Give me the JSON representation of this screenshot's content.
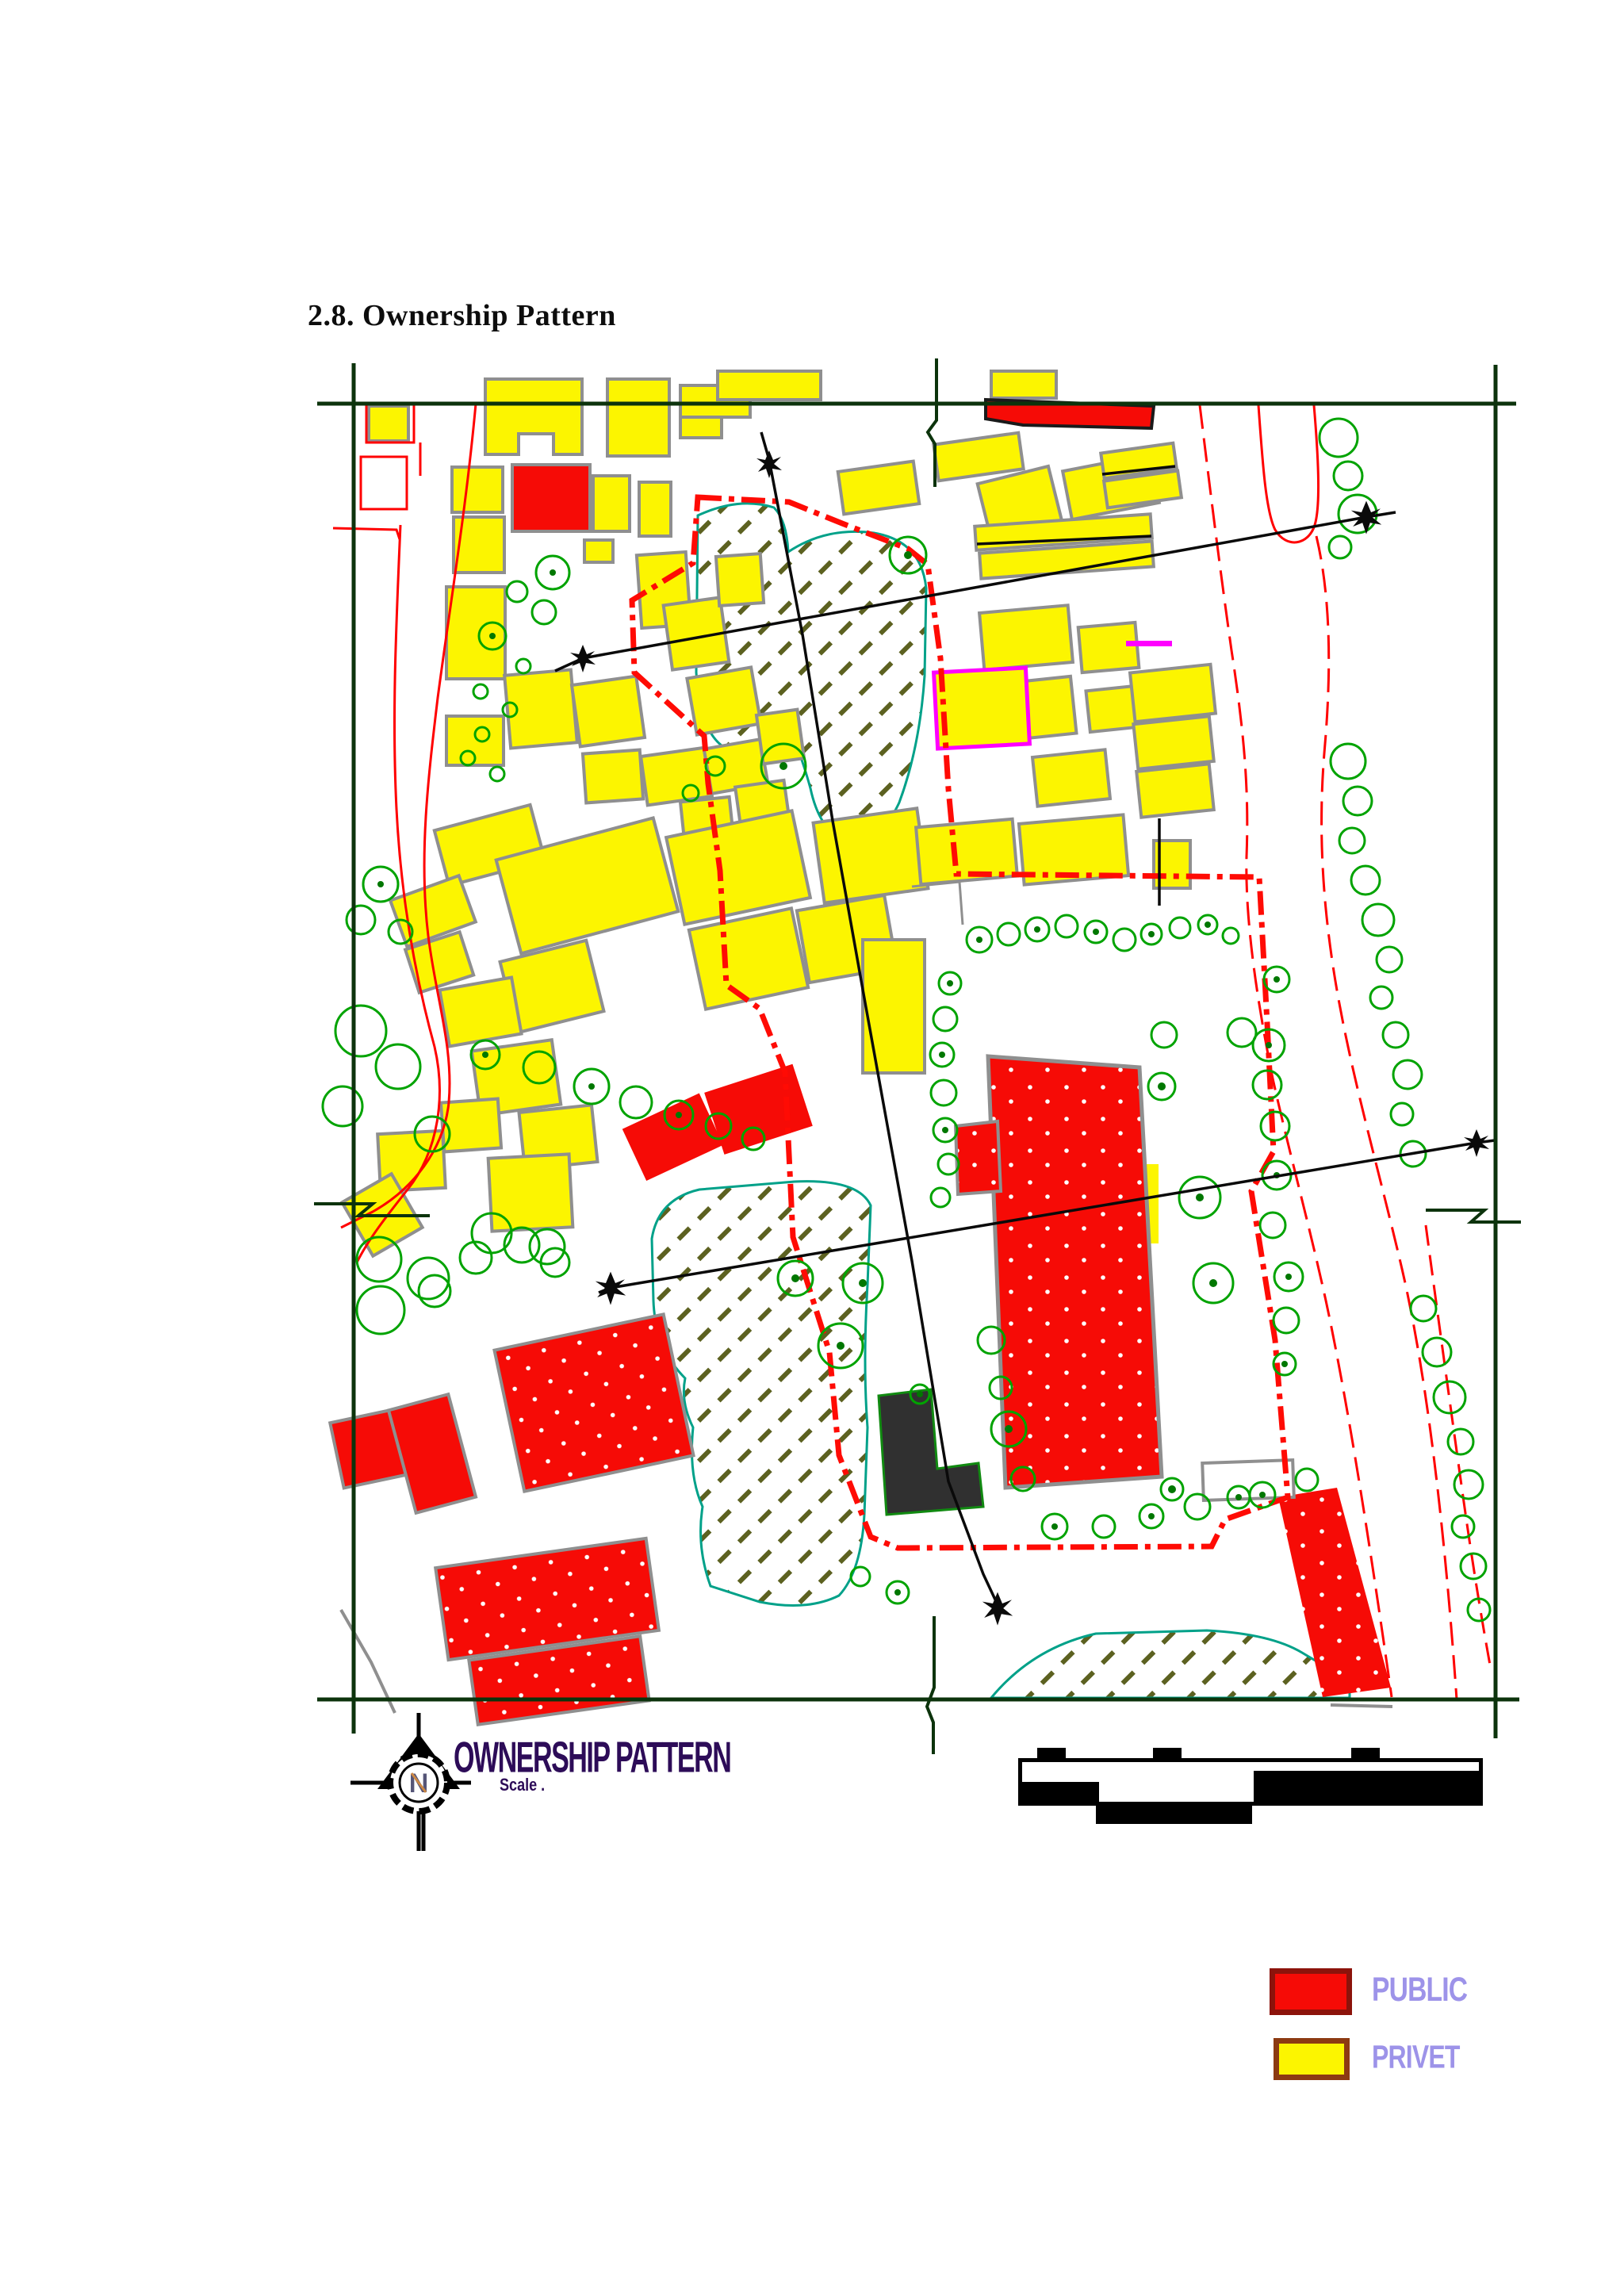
{
  "page": {
    "heading": "2.8. Ownership Pattern"
  },
  "map": {
    "title": "OWNERSHIP PATTERN",
    "scale_label": "Scale .",
    "compass_label": "N",
    "legend": {
      "text_color": "#9d93e9",
      "items": [
        {
          "label": "PUBLIC",
          "swatch_color": "#f60b06",
          "swatch_border": "#8c130b"
        },
        {
          "label": "PRIVET",
          "swatch_color": "#fcf500",
          "swatch_border": "#8c3a12"
        }
      ]
    },
    "colors": {
      "title_color": "#2d0c58",
      "public_fill": "#f60b06",
      "private_fill": "#fcf500",
      "tree_outline": "#00a300",
      "boundary_line": "#ff0b04",
      "road_line": "#ff0000",
      "frame_line": "#0c330c",
      "hatch_outline": "#00a189",
      "hatch_mark": "#5c6120",
      "survey_line": "#0a0a0a"
    }
  }
}
